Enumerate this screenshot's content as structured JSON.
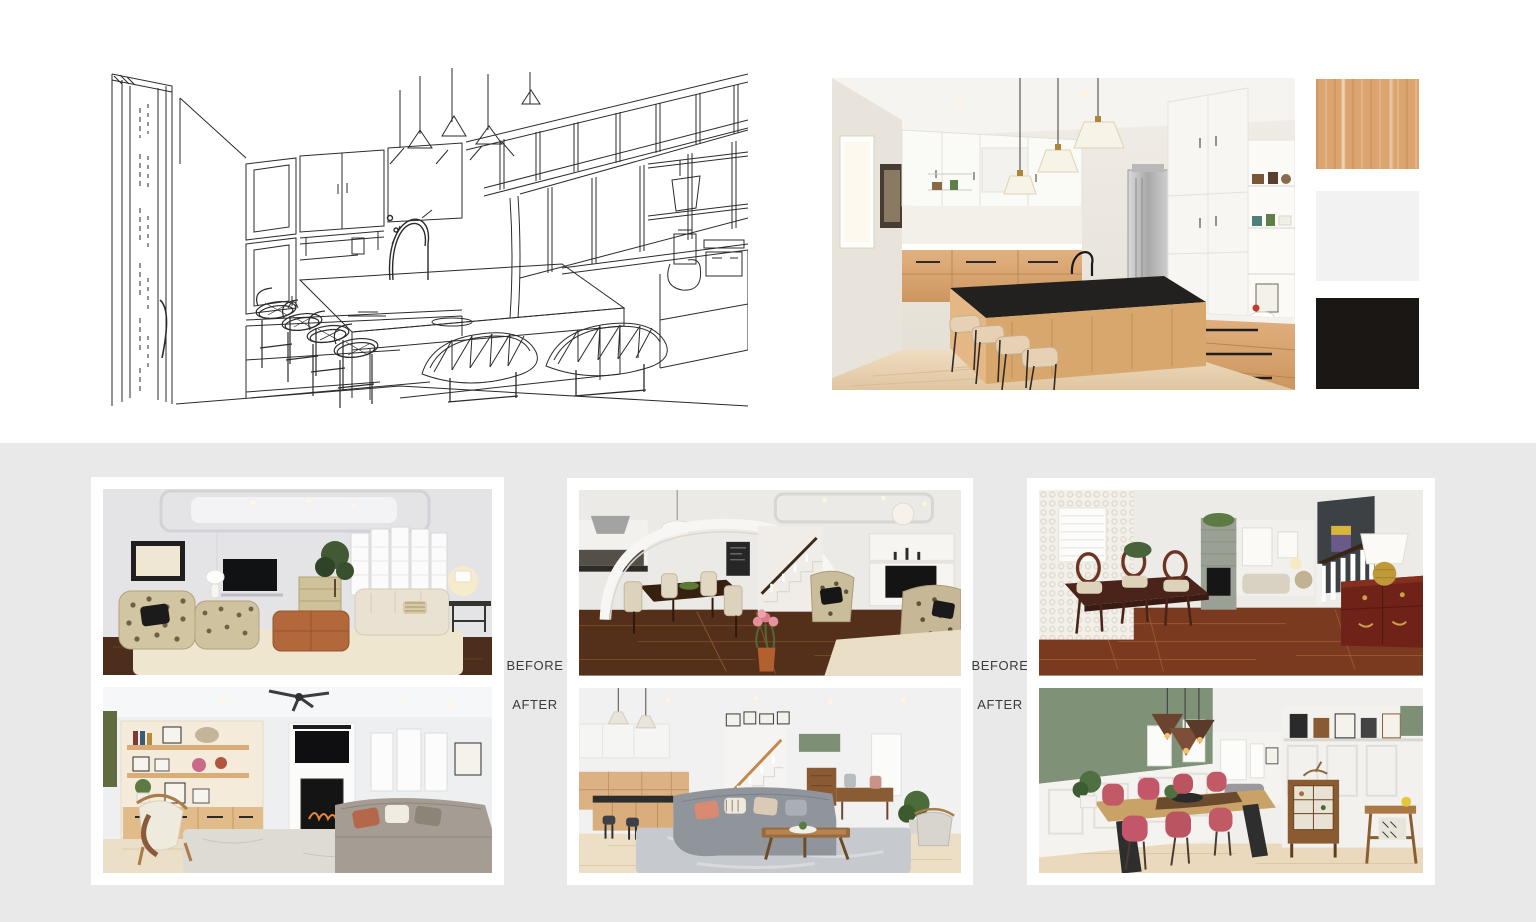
{
  "page": {
    "top_background": "#FFFFFF",
    "bottom_background": "#E9E9E9"
  },
  "concept": {
    "sketch": {
      "alt": "Black and white concept line sketch of a kitchen with island, bar stools, pendant lights, door and shelving"
    },
    "photo": {
      "alt": "Finished kitchen photo with white upper cabinets, light oak lower cabinets, black stone island, brass pendant lights and open shelving"
    },
    "palette": {
      "wood": {
        "name": "light-oak-wood-swatch",
        "color": "#DCA46E"
      },
      "light": {
        "name": "soft-white-swatch",
        "color": "#F2F2F2"
      },
      "dark": {
        "name": "matte-black-swatch",
        "color": "#1B1714"
      }
    }
  },
  "comparisons": {
    "label_before": "BEFORE",
    "label_after": "AFTER",
    "pairs": [
      {
        "id": "living-room",
        "before_alt": "Living room before: beige sofa, patterned armchairs, leather ottoman, bay window, dark hardwood floor",
        "after_alt": "Living room after: oak built-in shelves, fireplace with TV above, grey sectional, wood armchair, light rug"
      },
      {
        "id": "kitchen-dining",
        "before_alt": "Dining and kitchen before: white archway, dark hardwood, staircase, floral armchairs, capiz chandelier, tulips",
        "after_alt": "Open concept after: light oak kitchen, staircase gallery wall, grey sectional, wood coffee table, pale oak floor"
      },
      {
        "id": "dining-room",
        "before_alt": "Dining room before: textured white wall, dark wood dining set, stone fireplace column, navy wall, cherry sideboard, gold lamp",
        "after_alt": "Dining room after: sage green wall, white wainscoting, live-edge wood table, pink chairs, copper pendants, display cabinet"
      }
    ]
  }
}
